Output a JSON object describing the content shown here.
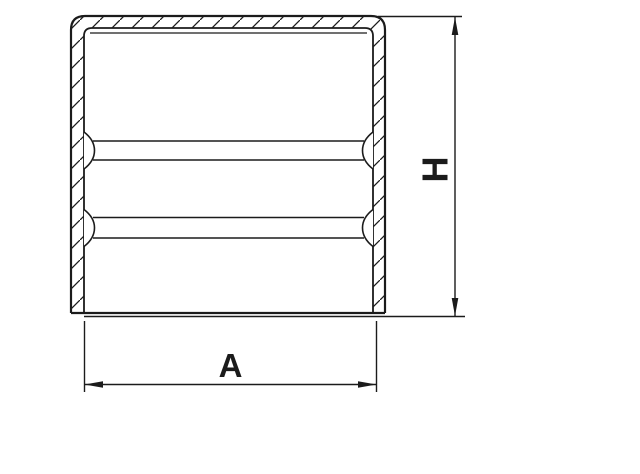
{
  "drawing": {
    "kind": "technical-section-drawing",
    "subject": "cylindrical end cap cross-section with two internal ribs and hatched cut walls",
    "background_color": "#ffffff",
    "line_color": "#1b1b1b",
    "dimensions": {
      "width": {
        "label": "A",
        "orientation": "horizontal",
        "measures": "outer width of cap opening"
      },
      "height": {
        "label": "H",
        "orientation": "vertical",
        "measures": "overall height of cap"
      }
    }
  }
}
